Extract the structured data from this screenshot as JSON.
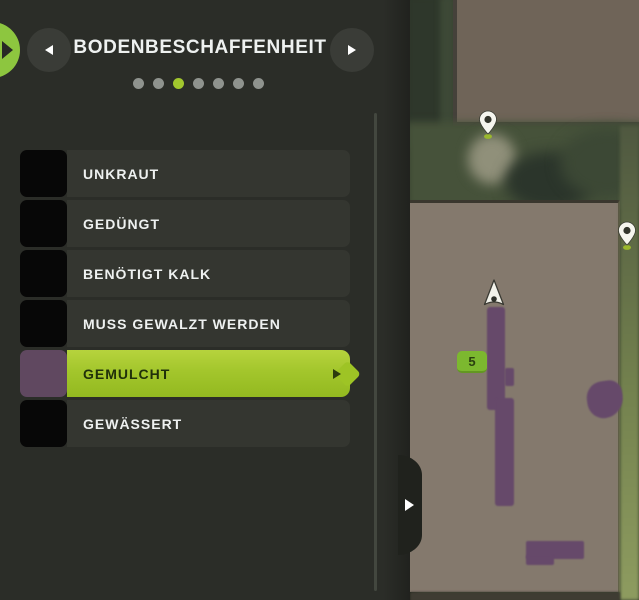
{
  "header": {
    "title": "BODENBESCHAFFENHEIT",
    "page_dots": {
      "count": 7,
      "active_index": 2
    }
  },
  "legend": {
    "items": [
      {
        "label": "UNKRAUT",
        "swatch": "#070707",
        "selected": false
      },
      {
        "label": "GEDÜNGT",
        "swatch": "#070707",
        "selected": false
      },
      {
        "label": "BENÖTIGT KALK",
        "swatch": "#070707",
        "selected": false
      },
      {
        "label": "MUSS GEWALZT WERDEN",
        "swatch": "#070707",
        "selected": false
      },
      {
        "label": "GEMULCHT",
        "swatch": "#604860",
        "selected": true
      },
      {
        "label": "GEWÄSSERT",
        "swatch": "#070707",
        "selected": false
      }
    ]
  },
  "map": {
    "field_number": "5"
  },
  "colors": {
    "panel-bg": "#2b2d28",
    "row-bg": "#343630",
    "highlight": "#a3c62c",
    "highlight-text": "#20300a",
    "text": "#eef1f0",
    "circle-btn": "#3a3c37",
    "dot": "#8f938e",
    "dot-active": "#a2c72e",
    "notch-green": "#8dc63f",
    "scroll-line": "#43473f",
    "edge-dark": "#20221d",
    "field-top": "#6f6458",
    "field-main": "#84796d",
    "mulch-purple": "#66496a",
    "terrain-dark": "#39432f",
    "badge-green": "#7cb82f",
    "badge-text": "#2a3f10"
  }
}
